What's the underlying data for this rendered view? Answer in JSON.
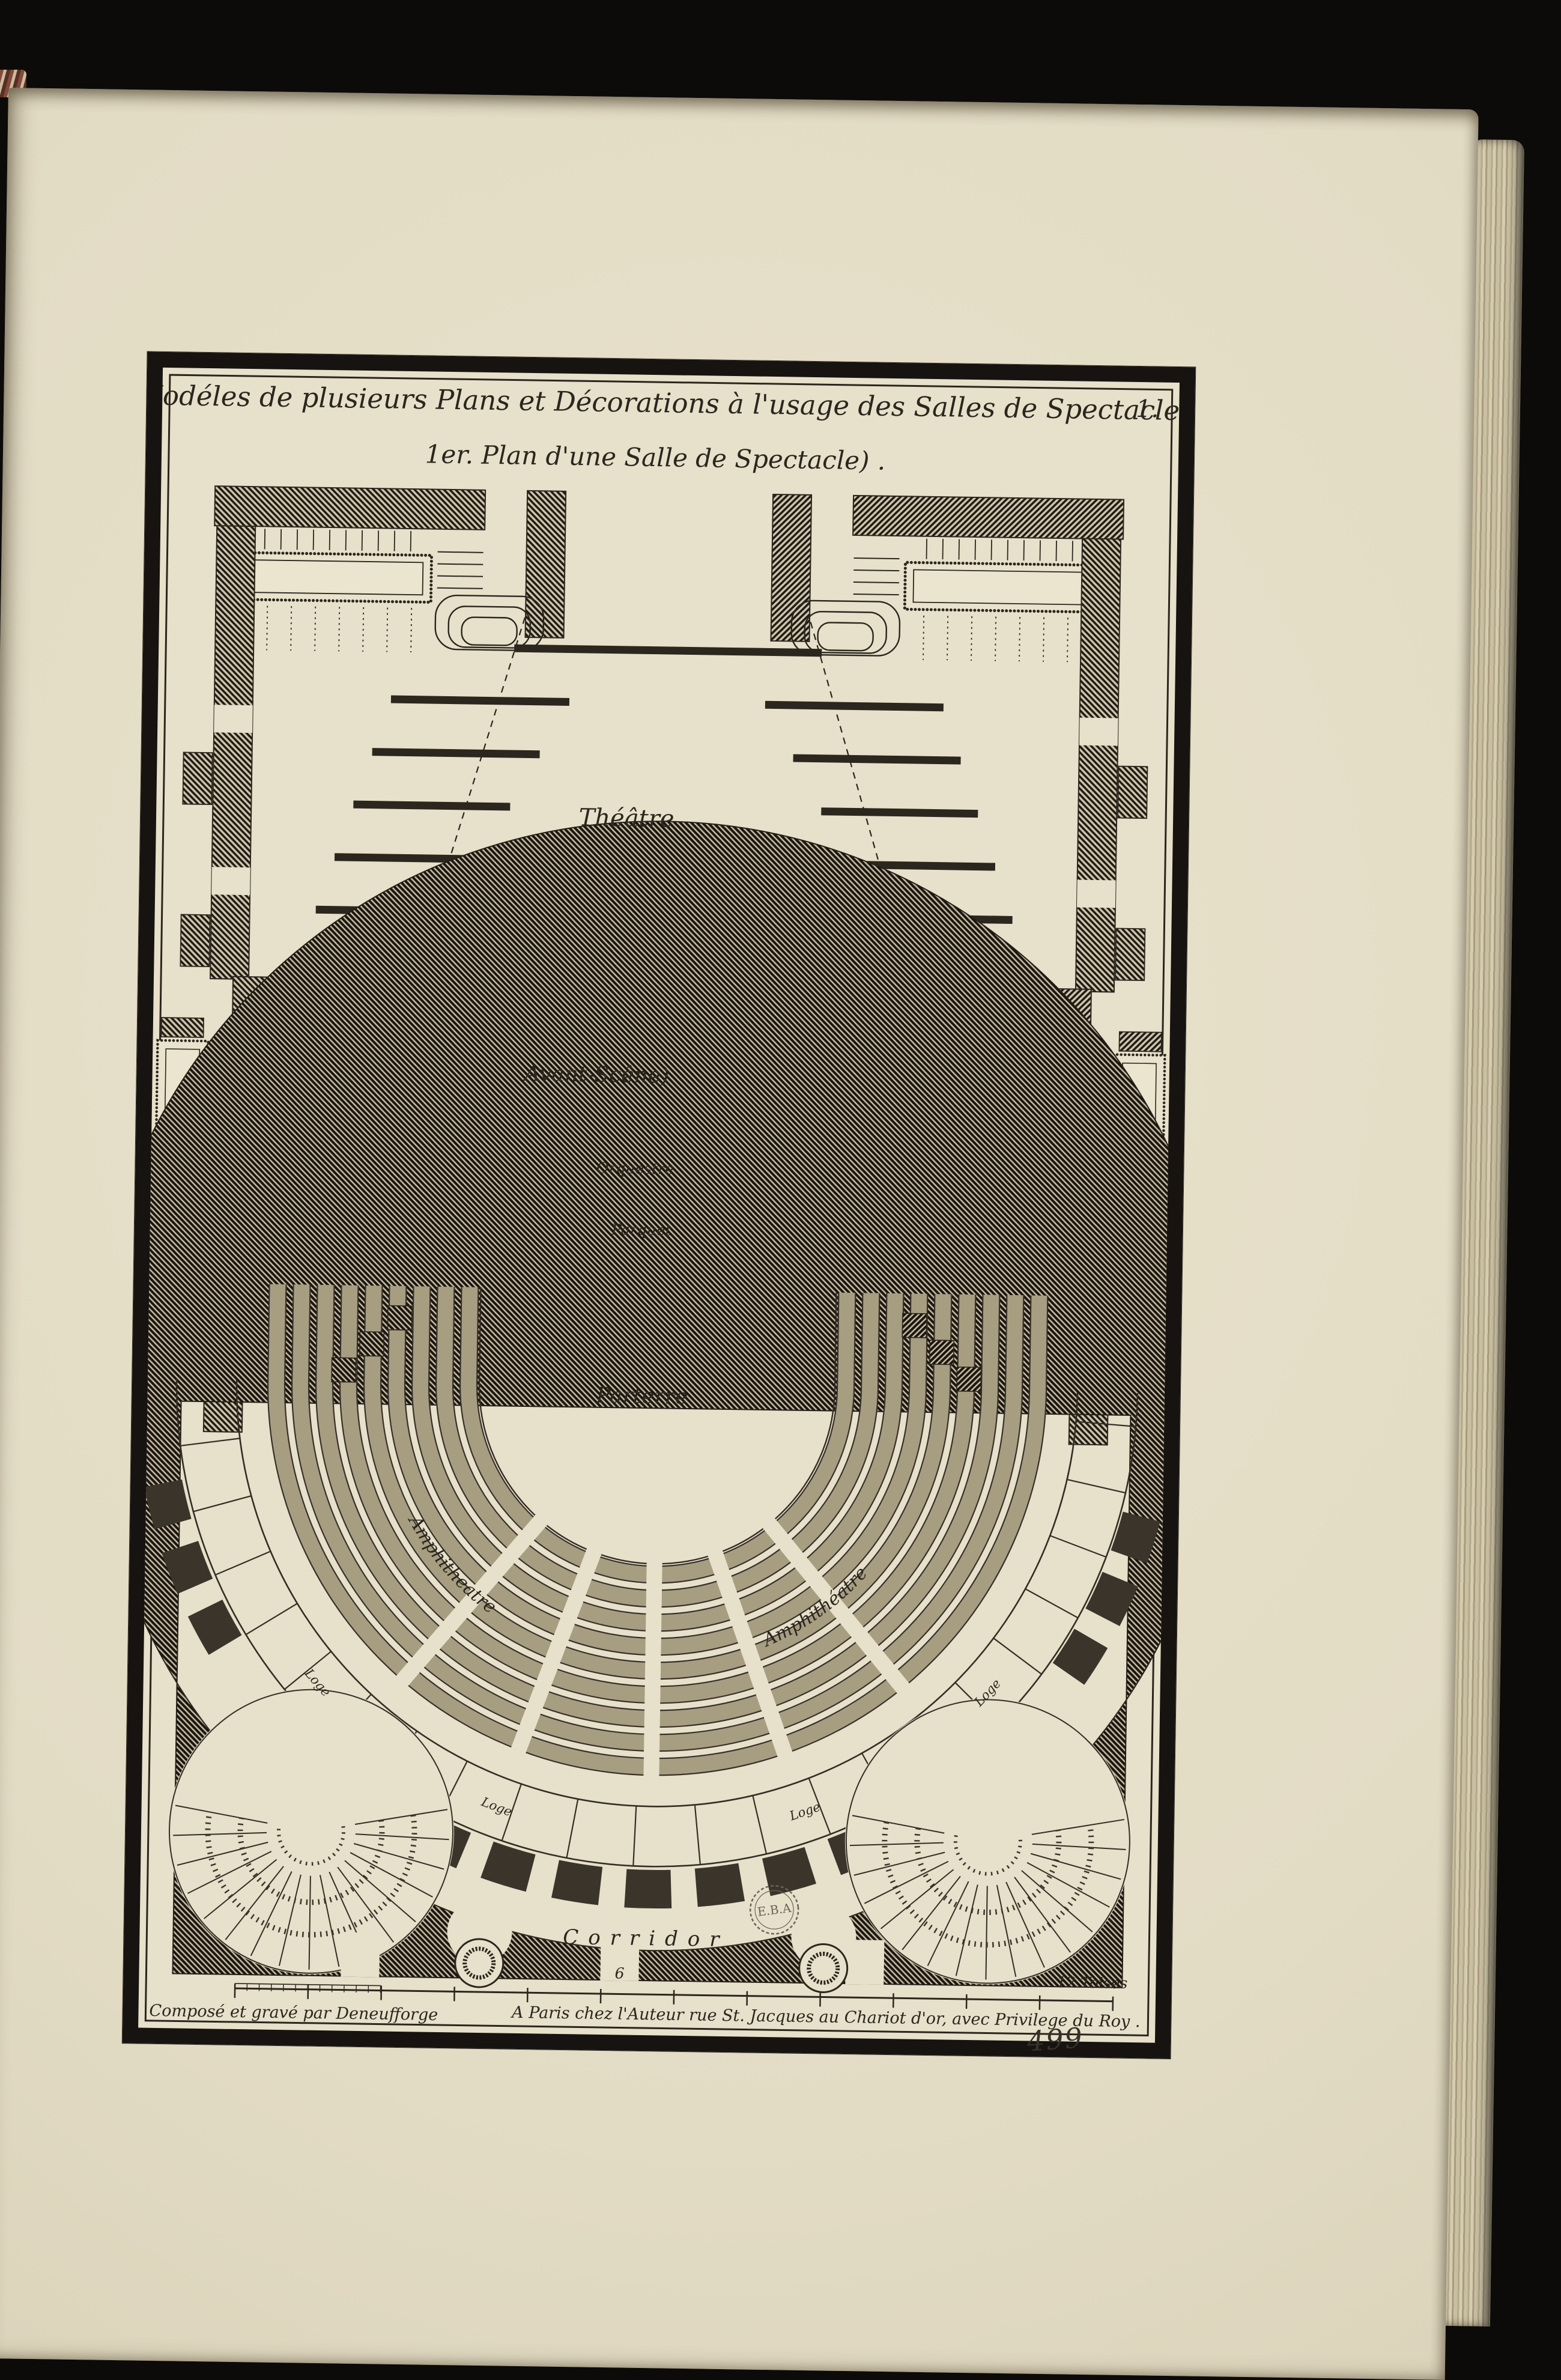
{
  "page": {
    "plate_number": "1.",
    "handwritten_number": "499",
    "stamp_text": "E.B.A"
  },
  "title": {
    "line1": "Modéles de plusieurs Plans et Décorations à l'usage des Salles de Spectacles ,",
    "line2": "1er. Plan d'une Salle de Spectacle) ."
  },
  "labels": {
    "theatre": "Théâtre",
    "avant_scene": "Avant-Scêne)",
    "orchestre": "Orquestre",
    "parquet": "Parquet",
    "parterre": "Parterre",
    "amphitheatre": "Amphitheatre",
    "amphitheatre_right": "Amphithéatre",
    "loge": "Loge",
    "corridor": "Corridor"
  },
  "scale_bar": {
    "mid_label": "6",
    "end_label": "12 Toises"
  },
  "credits": {
    "left": "Composé et gravé par Deneufforge",
    "right": "A Paris chez l'Auteur rue St. Jacques au Chariot d'or, avec Privilege du Roy ."
  },
  "colors": {
    "paper": "#e7e0ca",
    "ink": "#2b261e",
    "frame": "#161310",
    "background": "#0c0b09"
  }
}
